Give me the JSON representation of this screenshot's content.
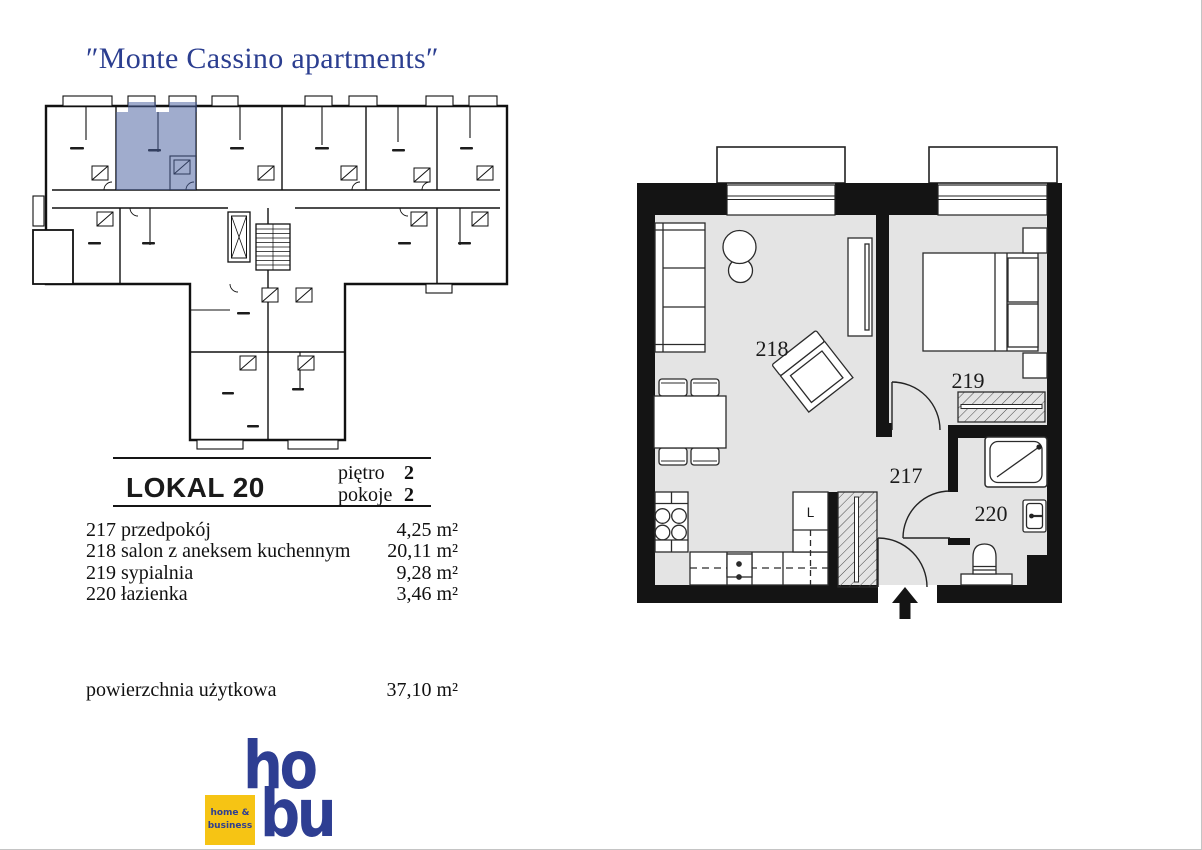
{
  "title": "″Monte Cassino apartments″",
  "colors": {
    "title_blue": "#2b3e90",
    "logo_blue": "#2e3e92",
    "logo_yellow": "#f6c414",
    "highlight_fill": "rgba(72,95,160,0.52)",
    "wall_black": "#141414",
    "floor_gray": "#e4e4e4"
  },
  "plan": {
    "room_hall": "217",
    "room_living": "218",
    "room_bedroom": "219",
    "room_bath": "220",
    "fridge_label": "L"
  },
  "details": {
    "unit": "LOKAL 20",
    "floor_label": "piętro",
    "floor_value": "2",
    "rooms_label": "pokoje",
    "rooms_value": "2",
    "rooms": [
      {
        "no": "217",
        "name": "przedpokój",
        "area": "4,25 m²"
      },
      {
        "no": "218",
        "name": "salon z aneksem kuchennym",
        "area": "20,11 m²"
      },
      {
        "no": "219",
        "name": "sypialnia",
        "area": "9,28 m²"
      },
      {
        "no": "220",
        "name": "łazienka",
        "area": "3,46 m²"
      }
    ],
    "total_label": "powierzchnia użytkowa",
    "total_area": "37,10 m²"
  },
  "logo": {
    "word_top": "ho",
    "word_bottom": "bu",
    "badge_line1": "home &",
    "badge_line2": "business"
  }
}
